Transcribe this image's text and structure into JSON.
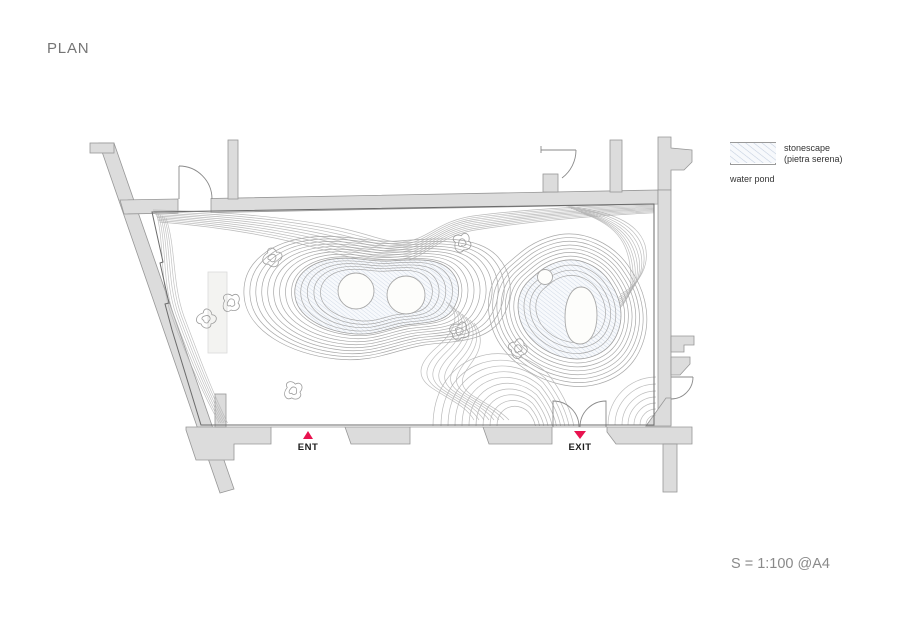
{
  "title": "PLAN",
  "legend": {
    "items": [
      {
        "label_line1": "stonescape",
        "label_line2": "(pietra serena)"
      },
      {
        "label_line1": "water pond",
        "label_line2": ""
      }
    ]
  },
  "markers": {
    "entrance_label": "ENT",
    "exit_label": "EXIT"
  },
  "scale_note": "S = 1:100 @A4",
  "colors": {
    "marker_red": "#e8134f",
    "wall_fill": "#dcdcdc",
    "contour_gray": "#b3b3b3",
    "pond_hatch_blue": "#c3cede"
  }
}
